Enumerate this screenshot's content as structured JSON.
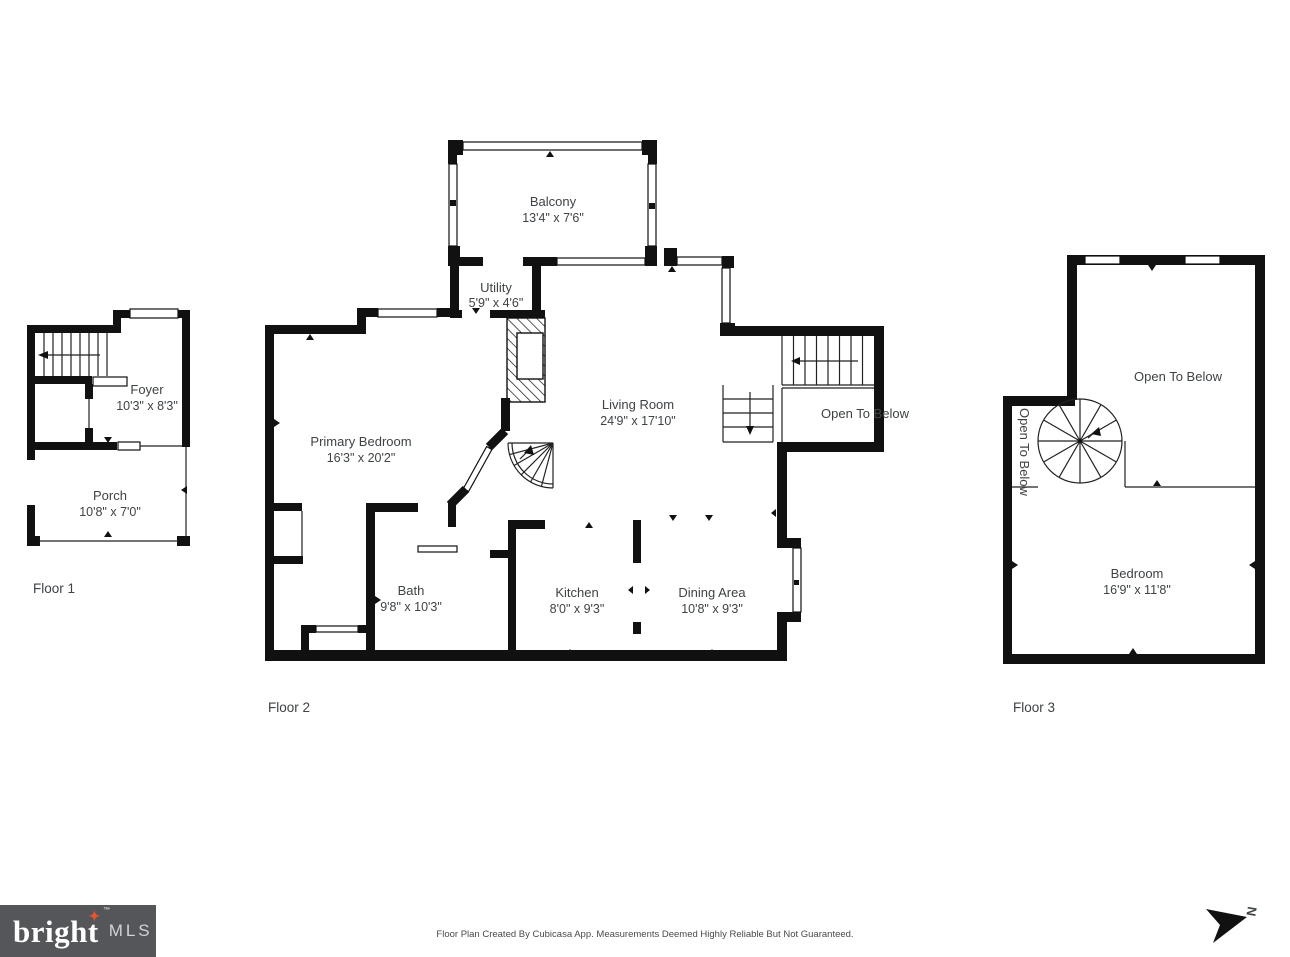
{
  "page": {
    "disclaimer": "Floor Plan Created By Cubicasa App. Measurements Deemed Highly Reliable But Not Guaranteed.",
    "logo": {
      "brand": "bright",
      "star": "✦",
      "tm": "™",
      "suffix": "MLS",
      "bg_color": "#55565a",
      "star_color": "#e2552d"
    },
    "compass": {
      "label": "N"
    },
    "colors": {
      "wall": "#111111",
      "text": "#3e4346",
      "background": "#ffffff"
    }
  },
  "floor1": {
    "label": "Floor 1",
    "foyer": {
      "name": "Foyer",
      "dims": "10'3\" x 8'3\""
    },
    "porch": {
      "name": "Porch",
      "dims": "10'8\" x 7'0\""
    }
  },
  "floor2": {
    "label": "Floor 2",
    "balcony": {
      "name": "Balcony",
      "dims": "13'4\" x 7'6\""
    },
    "utility": {
      "name": "Utility",
      "dims": "5'9\" x 4'6\""
    },
    "living": {
      "name": "Living Room",
      "dims": "24'9\" x 17'10\""
    },
    "open_below": {
      "name": "Open To Below"
    },
    "primary": {
      "name": "Primary Bedroom",
      "dims": "16'3\" x 20'2\""
    },
    "bath": {
      "name": "Bath",
      "dims": "9'8\" x 10'3\""
    },
    "kitchen": {
      "name": "Kitchen",
      "dims": "8'0\" x 9'3\""
    },
    "dining": {
      "name": "Dining Area",
      "dims": "10'8\" x 9'3\""
    }
  },
  "floor3": {
    "label": "Floor 3",
    "open_below": {
      "name": "Open To Below"
    },
    "open_below_side": {
      "name": "Open To Below"
    },
    "bedroom": {
      "name": "Bedroom",
      "dims": "16'9\" x 11'8\""
    }
  }
}
